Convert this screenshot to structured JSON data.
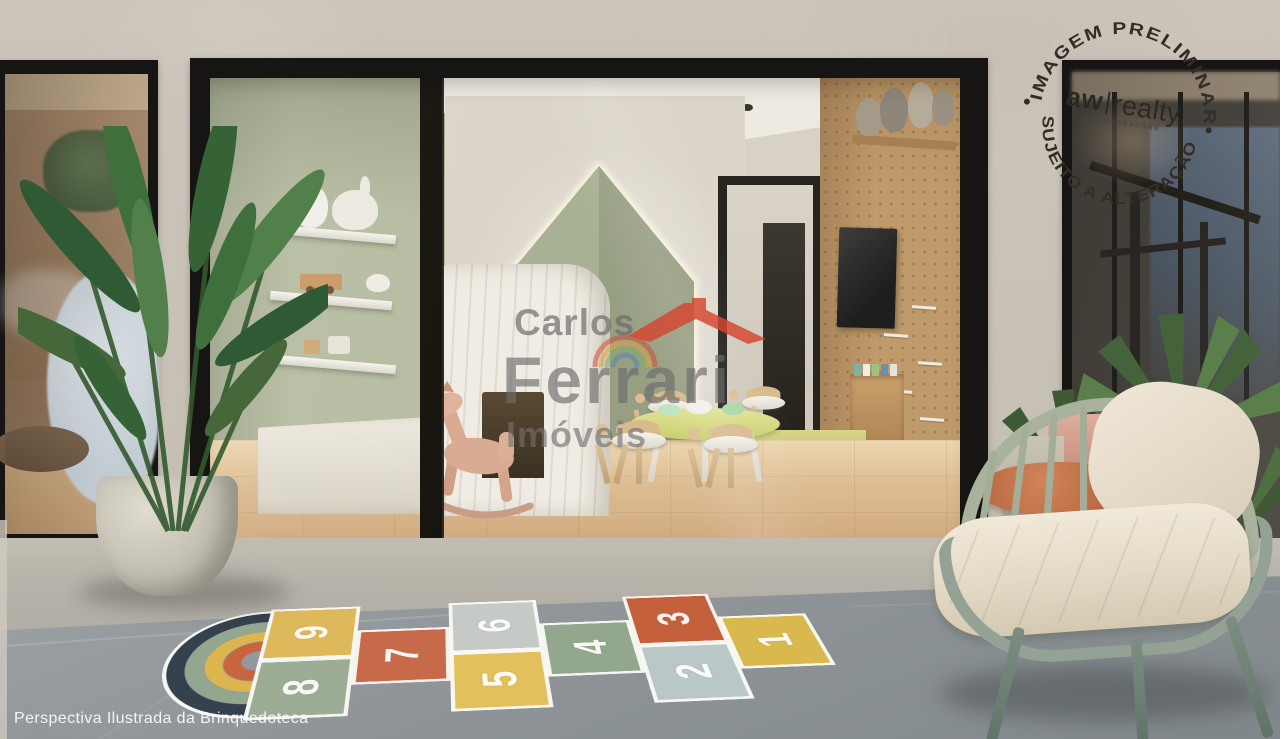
{
  "caption": {
    "text": "Perspectiva Ilustrada da Brinquedoteca"
  },
  "watermark": {
    "line1": "Carlos",
    "line2": "Ferrari",
    "line3": "Imóveis"
  },
  "stamp": {
    "arc_top": "IMAGEM PRELIMINAR",
    "arc_bottom": "SUJEITO A ALTERAÇÃO",
    "dot": "•",
    "brand_bold": "aw",
    "brand_regular": "realty",
    "brand_sub": "INCORPORADORA"
  },
  "hopscotch": {
    "tiles": [
      {
        "label": "9",
        "color": "#ddb95b"
      },
      {
        "label": "8",
        "color": "#9dac95"
      },
      {
        "label": "7",
        "color": "#c66a4a"
      },
      {
        "label": "6",
        "color": "#c5cac6"
      },
      {
        "label": "5",
        "color": "#e2c05c"
      },
      {
        "label": "4",
        "color": "#93a78c"
      },
      {
        "label": "3",
        "color": "#c4603c"
      },
      {
        "label": "2",
        "color": "#b9c7c9"
      },
      {
        "label": "1",
        "color": "#d9b94e"
      }
    ],
    "rainbow_rings": [
      "#35424e",
      "#93a78f",
      "#dcb54f",
      "#c8653f"
    ],
    "rainbow_outline": "#f6f5f1"
  },
  "colors": {
    "facade": "#c9c2b8",
    "window_frame": "#171513",
    "sage_wall": "#b7bda2",
    "cream_wall": "#dbd5ca",
    "led_panel": "#a9b194",
    "led_glow": "#fff8e4",
    "pegboard_wood": "#bf9a6b",
    "interior_floor": "#dcc09a",
    "concrete_light": "#b4b0a7",
    "concrete_dark": "#8c9296",
    "chair_frame": "#a8b29d",
    "cushion": "#e9e1d0",
    "terracotta_table": "#c3714f",
    "watermark_gray": "#6c6c6c",
    "logo_red": "#d6452f"
  }
}
